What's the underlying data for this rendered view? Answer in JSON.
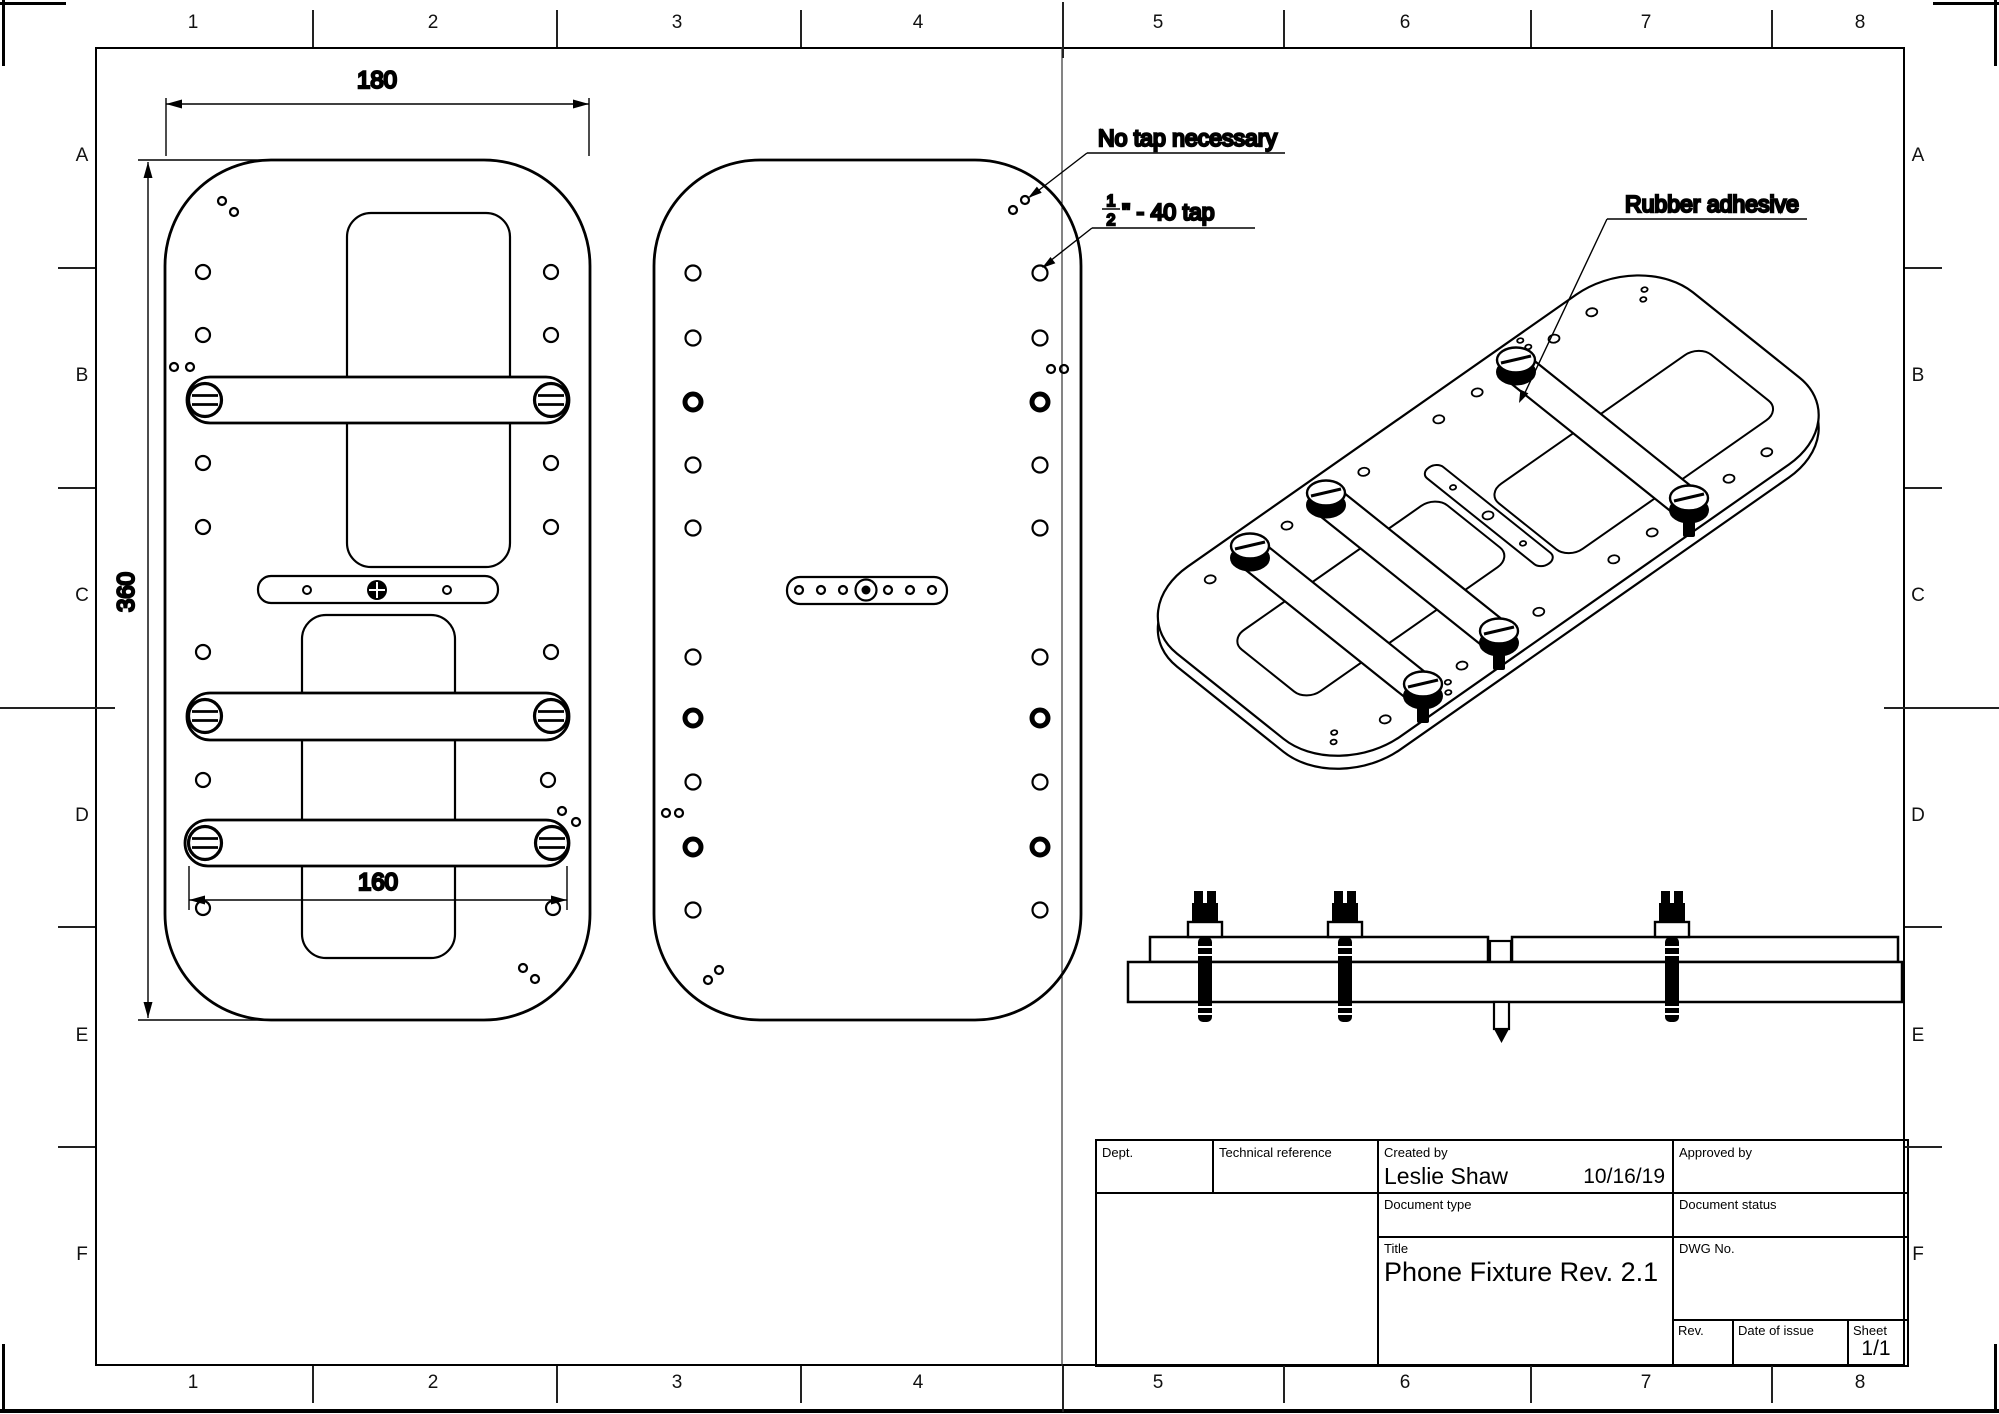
{
  "grid": {
    "cols": [
      "1",
      "2",
      "3",
      "4",
      "5",
      "6",
      "7",
      "8"
    ],
    "rows": [
      "A",
      "B",
      "C",
      "D",
      "E",
      "F"
    ]
  },
  "views": {
    "front": {
      "dim_width": "180",
      "dim_height": "360",
      "dim_screws": "160"
    },
    "back": {
      "note_no_tap": "No tap necessary",
      "note_tap_num": "1",
      "note_tap_den": "2",
      "note_tap_rest": "\" - 40 tap"
    },
    "iso": {
      "note_rubber": "Rubber adhesive"
    }
  },
  "title_block": {
    "dept_label": "Dept.",
    "tech_ref_label": "Technical reference",
    "created_by_label": "Created by",
    "created_by_name": "Leslie Shaw",
    "created_date": "10/16/19",
    "approved_by_label": "Approved by",
    "doc_type_label": "Document type",
    "doc_status_label": "Document status",
    "title_label": "Title",
    "title_value": "Phone Fixture Rev. 2.1",
    "dwg_no_label": "DWG No.",
    "rev_label": "Rev.",
    "date_of_issue_label": "Date of issue",
    "sheet_label": "Sheet",
    "sheet_value": "1/1"
  },
  "colors": {
    "line": "#000000",
    "background": "#ffffff"
  }
}
